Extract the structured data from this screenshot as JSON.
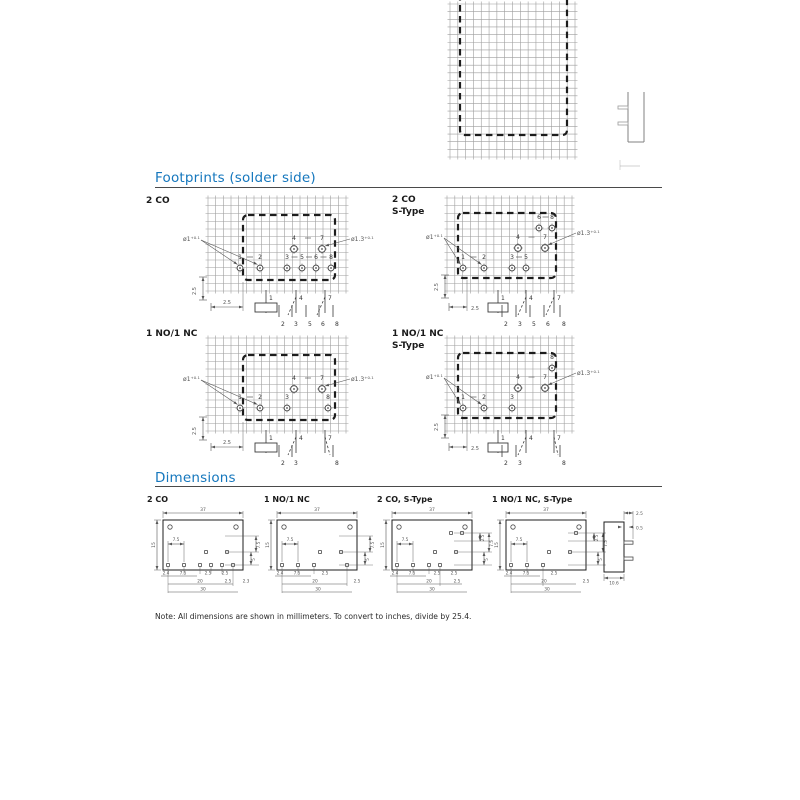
{
  "style": {
    "accent": "#1577bd",
    "ink": "#1c1c1c",
    "grid_line": "#9e9e9e",
    "dim_line": "#555555",
    "pin_line": "#4a4a4a",
    "rule_line": "#4a4a4a"
  },
  "headings": {
    "footprints": "Footprints (solder side)",
    "dimensions": "Dimensions"
  },
  "note": "Note: All dimensions are shown in millimeters. To convert to inches, divide by 25.4.",
  "footprint_labels": [
    {
      "line1": "2 CO",
      "line2": ""
    },
    {
      "line1": "2 CO",
      "line2": "S-Type"
    },
    {
      "line1": "1 NO/1 NC",
      "line2": ""
    },
    {
      "line1": "1 NO/1 NC",
      "line2": "S-Type"
    }
  ],
  "dimension_labels": [
    "2 CO",
    "1 NO/1 NC",
    "2 CO, S-Type",
    "1 NO/1 NC, S-Type"
  ],
  "hole_small": {
    "base": "ø1",
    "tol": "+0.1"
  },
  "hole_large": {
    "base": "ø1.3",
    "tol": "+0.1"
  },
  "pitch_dim": "2.5",
  "footprint_diagrams": [
    {
      "id": "2co",
      "grid": [
        208,
        198,
        346,
        291
      ],
      "outline": [
        243,
        215,
        335,
        280
      ],
      "rows": [
        {
          "y": 268,
          "ly": 259,
          "mode": "auto",
          "large": false,
          "pins": [
            [
              "1",
              240
            ],
            [
              "2",
              260
            ],
            [
              "3",
              287
            ],
            [
              "5",
              302
            ],
            [
              "6",
              316
            ],
            [
              "8",
              331
            ]
          ]
        },
        {
          "y": 249,
          "ly": 240,
          "mode": "all",
          "large": true,
          "pins": [
            [
              "4",
              294
            ],
            [
              "7",
              322
            ]
          ]
        }
      ],
      "hole_small_at": [
        200,
        241
      ],
      "hole_small_targets": [
        "1",
        "2"
      ],
      "hole_large_at": [
        351,
        241
      ],
      "hole_large_target": "7",
      "vdim": {
        "x": 203,
        "y1": 277,
        "y2": 300,
        "lx": 196,
        "ly": 291
      },
      "hdim": {
        "x1": 211,
        "x2": 243,
        "y": 307,
        "lx": 227,
        "ly": 304,
        "anchor": "middle",
        "ext_from": 280
      },
      "sch": {
        "top": [
          [
            "1",
            266
          ],
          [
            "4",
            296
          ],
          [
            "7",
            325
          ]
        ],
        "y1": 290,
        "y2": 313,
        "lly": 300,
        "coil": [
          255,
          303,
          22,
          9
        ],
        "bottom": [
          [
            "2",
            279
          ],
          [
            "3",
            292
          ],
          [
            "5",
            306
          ],
          [
            "6",
            319
          ],
          [
            "8",
            333
          ]
        ],
        "by1": 305,
        "by2": 317,
        "bly": 326,
        "diag": [
          [
            296,
            297,
            288,
            315
          ],
          [
            325,
            297,
            317,
            315
          ]
        ]
      }
    },
    {
      "id": "2co-s",
      "grid": [
        447,
        198,
        572,
        291
      ],
      "outline": [
        458,
        213,
        556,
        278
      ],
      "rows": [
        {
          "y": 268,
          "ly": 259,
          "mode": "auto",
          "large": false,
          "pins": [
            [
              "1",
              463
            ],
            [
              "2",
              484
            ],
            [
              "3",
              512
            ],
            [
              "5",
              526
            ]
          ]
        },
        {
          "y": 248,
          "ly": 239,
          "mode": "all",
          "large": true,
          "pins": [
            [
              "4",
              518
            ],
            [
              "7",
              545
            ]
          ]
        },
        {
          "y": 228,
          "ly": 219,
          "mode": "all",
          "large": false,
          "pins": [
            [
              "6",
              539
            ],
            [
              "8",
              552
            ]
          ]
        }
      ],
      "hole_small_at": [
        443,
        239
      ],
      "hole_small_targets": [
        "1",
        "2"
      ],
      "hole_large_at": [
        577,
        235
      ],
      "hole_large_target": "7",
      "vdim": {
        "x": 445,
        "y1": 275,
        "y2": 298,
        "lx": 438,
        "ly": 287
      },
      "hdim": {
        "x1": 449,
        "x2": 467,
        "y": 307,
        "lx": 471,
        "ly": 310,
        "anchor": "start",
        "ext_from": 278
      },
      "sch": {
        "top": [
          [
            "1",
            498
          ],
          [
            "4",
            526
          ],
          [
            "7",
            554
          ]
        ],
        "y1": 290,
        "y2": 313,
        "lly": 300,
        "coil": [
          488,
          303,
          20,
          9
        ],
        "bottom": [
          [
            "2",
            502
          ],
          [
            "3",
            516
          ],
          [
            "5",
            530
          ],
          [
            "6",
            544
          ],
          [
            "8",
            560
          ]
        ],
        "by1": 305,
        "by2": 317,
        "bly": 326,
        "diag": [
          [
            526,
            297,
            518,
            315
          ],
          [
            554,
            297,
            546,
            315
          ]
        ]
      }
    },
    {
      "id": "1no1nc",
      "grid": [
        208,
        338,
        346,
        431
      ],
      "outline": [
        243,
        355,
        335,
        420
      ],
      "rows": [
        {
          "y": 408,
          "ly": 399,
          "mode": "auto",
          "large": false,
          "pins": [
            [
              "1",
              240
            ],
            [
              "2",
              260
            ],
            [
              "3",
              287
            ],
            [
              "8",
              328
            ]
          ]
        },
        {
          "y": 389,
          "ly": 380,
          "mode": "all",
          "large": true,
          "pins": [
            [
              "4",
              294
            ],
            [
              "7",
              322
            ]
          ]
        }
      ],
      "hole_small_at": [
        200,
        381
      ],
      "hole_small_targets": [
        "1",
        "2"
      ],
      "hole_large_at": [
        351,
        381
      ],
      "hole_large_target": "7",
      "vdim": {
        "x": 203,
        "y1": 417,
        "y2": 440,
        "lx": 196,
        "ly": 431
      },
      "hdim": {
        "x1": 211,
        "x2": 243,
        "y": 447,
        "lx": 227,
        "ly": 444,
        "anchor": "middle",
        "ext_from": 420
      },
      "sch": {
        "top": [
          [
            "1",
            266
          ],
          [
            "4",
            296
          ],
          [
            "7",
            325
          ]
        ],
        "y1": 430,
        "y2": 453,
        "lly": 440,
        "coil": [
          255,
          443,
          22,
          9
        ],
        "bottom": [
          [
            "2",
            279
          ],
          [
            "3",
            292
          ],
          [
            "8",
            333
          ]
        ],
        "by1": 445,
        "by2": 457,
        "bly": 465,
        "diag": [
          [
            296,
            437,
            288,
            455
          ],
          [
            325,
            437,
            330,
            455
          ]
        ]
      }
    },
    {
      "id": "1no1nc-s",
      "grid": [
        447,
        338,
        572,
        431
      ],
      "outline": [
        458,
        353,
        556,
        418
      ],
      "rows": [
        {
          "y": 408,
          "ly": 399,
          "mode": "auto",
          "large": false,
          "pins": [
            [
              "1",
              463
            ],
            [
              "2",
              484
            ],
            [
              "3",
              512
            ]
          ]
        },
        {
          "y": 388,
          "ly": 379,
          "mode": "all",
          "large": true,
          "pins": [
            [
              "4",
              518
            ],
            [
              "7",
              545
            ]
          ]
        },
        {
          "y": 368,
          "ly": 359,
          "mode": "all",
          "large": false,
          "pins": [
            [
              "8",
              552
            ]
          ]
        }
      ],
      "hole_small_at": [
        443,
        379
      ],
      "hole_small_targets": [
        "1",
        "2"
      ],
      "hole_large_at": [
        577,
        375
      ],
      "hole_large_target": "7",
      "vdim": {
        "x": 445,
        "y1": 415,
        "y2": 438,
        "lx": 438,
        "ly": 427
      },
      "hdim": {
        "x1": 449,
        "x2": 467,
        "y": 447,
        "lx": 471,
        "ly": 450,
        "anchor": "start",
        "ext_from": 418
      },
      "sch": {
        "top": [
          [
            "1",
            498
          ],
          [
            "4",
            526
          ],
          [
            "7",
            554
          ]
        ],
        "y1": 430,
        "y2": 453,
        "lly": 440,
        "coil": [
          488,
          443,
          20,
          9
        ],
        "bottom": [
          [
            "2",
            502
          ],
          [
            "3",
            516
          ],
          [
            "8",
            560
          ]
        ],
        "by1": 445,
        "by2": 457,
        "bly": 465,
        "diag": [
          [
            526,
            437,
            518,
            455
          ],
          [
            554,
            437,
            558,
            455
          ]
        ]
      }
    }
  ],
  "dimension_drawings": [
    {
      "label": "2 CO",
      "ox": 163,
      "pins_bottom": [
        5,
        21,
        37,
        48,
        59,
        70
      ],
      "pins_mid": [
        43,
        64
      ],
      "pins_top": [],
      "top_dim": "37",
      "left_dim": "15",
      "inner_dim": "7.5",
      "right_dims": [
        {
          "x": 93,
          "y1": 536,
          "y2": 552,
          "t": "7.5"
        },
        {
          "x": 88,
          "y1": 552,
          "y2": 565,
          "t": "5"
        }
      ],
      "tiers": [
        {
          "y": 576,
          "x1": -2,
          "x2": 34,
          "labels": [
            [
              "2.4",
              3
            ],
            [
              "7.5",
              20
            ],
            [
              "2.5",
              45
            ],
            [
              "2.5",
              62
            ]
          ]
        },
        {
          "y": 584,
          "x1": 5,
          "x2": 70,
          "labels": [
            [
              "20",
              37
            ],
            [
              "2.5",
              65
            ],
            [
              "2.3",
              83
            ]
          ]
        },
        {
          "y": 592,
          "x1": 5,
          "x2": 75,
          "labels": [
            [
              "30",
              40
            ]
          ]
        }
      ]
    },
    {
      "label": "1 NO/1 NC",
      "ox": 277,
      "pins_bottom": [
        5,
        21,
        37,
        70
      ],
      "pins_mid": [
        43,
        64
      ],
      "pins_top": [],
      "top_dim": "37",
      "left_dim": "15",
      "inner_dim": "7.5",
      "right_dims": [
        {
          "x": 93,
          "y1": 536,
          "y2": 552,
          "t": "7.5"
        },
        {
          "x": 88,
          "y1": 552,
          "y2": 565,
          "t": "5"
        }
      ],
      "tiers": [
        {
          "y": 576,
          "x1": -2,
          "x2": 34,
          "labels": [
            [
              "2.4",
              3
            ],
            [
              "7.5",
              20
            ],
            [
              "2.5",
              48
            ]
          ]
        },
        {
          "y": 584,
          "x1": 5,
          "x2": 70,
          "labels": [
            [
              "20",
              38
            ],
            [
              "2.5",
              80
            ]
          ]
        },
        {
          "y": 592,
          "x1": 5,
          "x2": 75,
          "labels": [
            [
              "30",
              41
            ]
          ]
        }
      ]
    },
    {
      "label": "2 CO, S-Type",
      "ox": 392,
      "pins_bottom": [
        5,
        21,
        37,
        48
      ],
      "pins_mid": [
        43,
        64
      ],
      "pins_top": [
        59,
        70
      ],
      "top_dim": "37",
      "left_dim": "15",
      "inner_dim": "7.5",
      "right_dims": [
        {
          "x": 97,
          "y1": 533,
          "y2": 552,
          "t": "7.5"
        },
        {
          "x": 88,
          "y1": 533,
          "y2": 541,
          "t": "2.5"
        },
        {
          "x": 92,
          "y1": 552,
          "y2": 565,
          "t": "5"
        }
      ],
      "tiers": [
        {
          "y": 576,
          "x1": -2,
          "x2": 34,
          "labels": [
            [
              "2.4",
              3
            ],
            [
              "7.5",
              20
            ],
            [
              "2.5",
              45
            ],
            [
              "2.5",
              62
            ]
          ]
        },
        {
          "y": 584,
          "x1": 5,
          "x2": 70,
          "labels": [
            [
              "20",
              37
            ],
            [
              "2.5",
              65
            ]
          ]
        },
        {
          "y": 592,
          "x1": 5,
          "x2": 75,
          "labels": [
            [
              "30",
              40
            ]
          ]
        }
      ]
    },
    {
      "label": "1 NO/1 NC, S-Type",
      "ox": 506,
      "pins_bottom": [
        5,
        21,
        37
      ],
      "pins_mid": [
        43,
        64
      ],
      "pins_top": [
        70
      ],
      "top_dim": "37",
      "left_dim": "15",
      "inner_dim": "7.5",
      "right_dims": [
        {
          "x": 97,
          "y1": 533,
          "y2": 552,
          "t": "7.5"
        },
        {
          "x": 88,
          "y1": 533,
          "y2": 541,
          "t": "2.5"
        },
        {
          "x": 92,
          "y1": 552,
          "y2": 565,
          "t": "5"
        }
      ],
      "tiers": [
        {
          "y": 576,
          "x1": -2,
          "x2": 34,
          "labels": [
            [
              "2.4",
              3
            ],
            [
              "7.5",
              20
            ],
            [
              "2.5",
              48
            ]
          ]
        },
        {
          "y": 584,
          "x1": 5,
          "x2": 70,
          "labels": [
            [
              "20",
              38
            ],
            [
              "2.5",
              80
            ]
          ]
        },
        {
          "y": 592,
          "x1": 5,
          "x2": 75,
          "labels": [
            [
              "30",
              41
            ]
          ]
        }
      ]
    }
  ],
  "side_view": {
    "x": 604,
    "y": 522,
    "w": 20,
    "h": 50,
    "pins_y": [
      541,
      557
    ],
    "top_dim": "2.5",
    "pin_dim": "0.5",
    "bottom_dim": "10.6"
  },
  "top_fragment": {
    "grid": [
      450,
      4,
      575,
      157
    ],
    "outline": {
      "x1": 460,
      "x2": 567,
      "yb": 135
    },
    "element": {
      "x1": 628,
      "x2": 644,
      "y1": 92,
      "y2": 142,
      "pins_y": [
        106,
        122
      ]
    }
  }
}
